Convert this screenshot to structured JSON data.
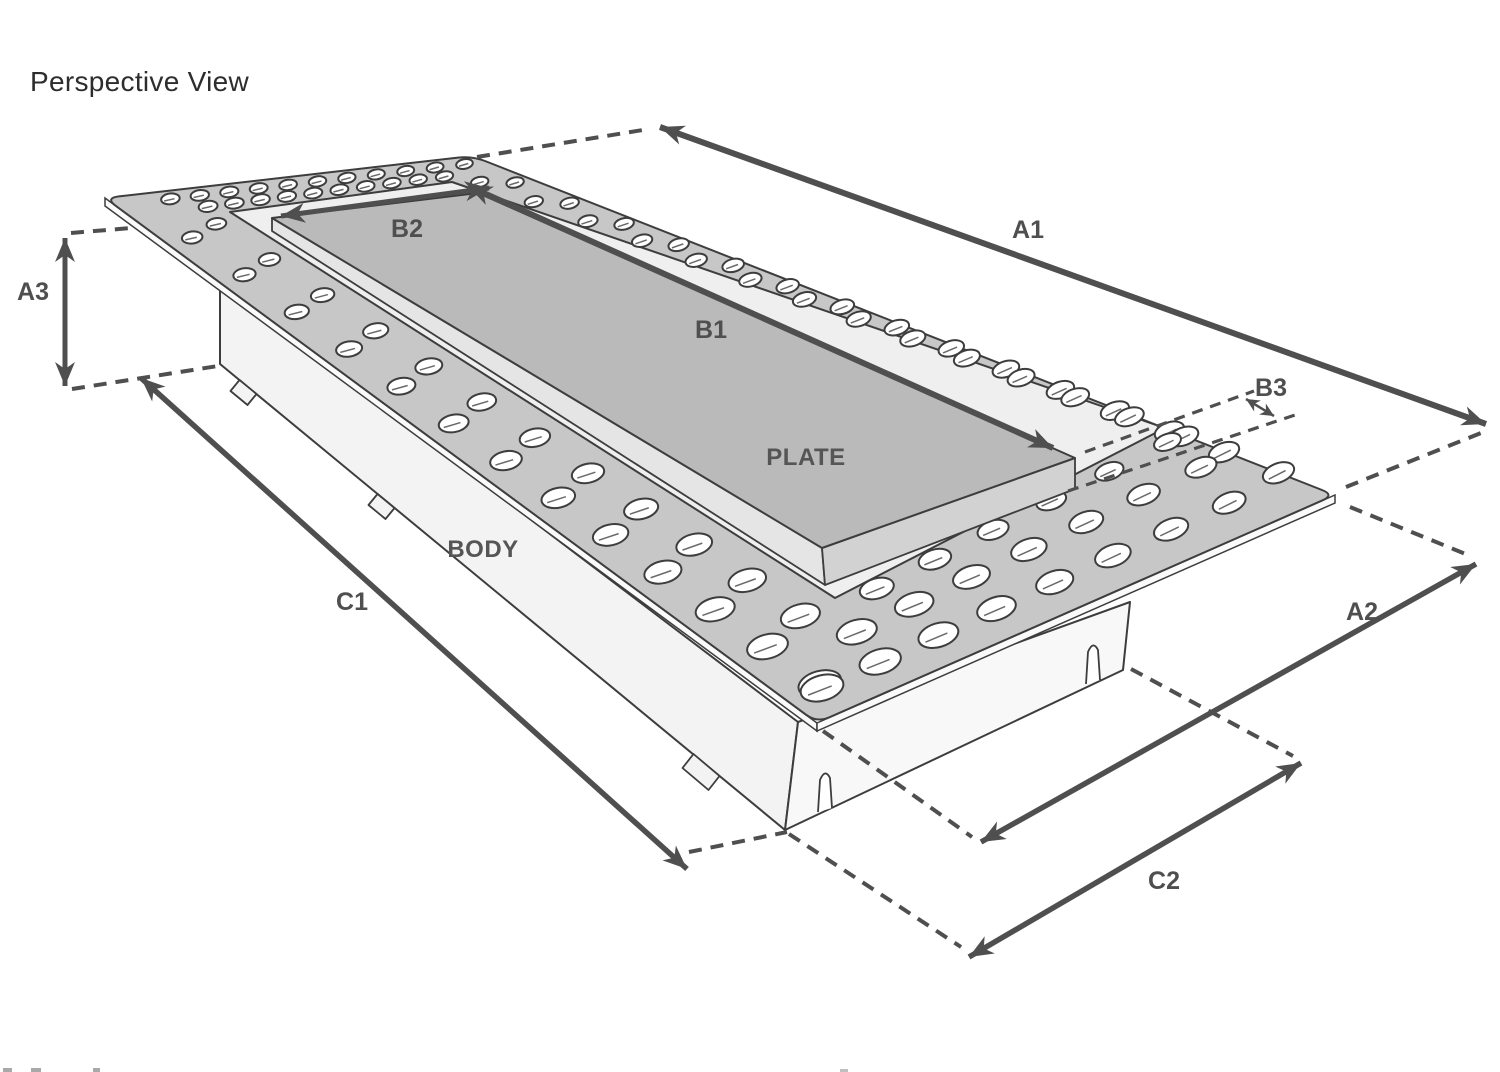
{
  "title": "Perspective View",
  "part_labels": {
    "plate": "PLATE",
    "body": "BODY"
  },
  "dimensions": {
    "A1": "A1",
    "A2": "A2",
    "A3": "A3",
    "B1": "B1",
    "B2": "B2",
    "B3": "B3",
    "C1": "C1",
    "C2": "C2"
  },
  "colors": {
    "background": "#ffffff",
    "line": "#3d3d3d",
    "dim": "#4f4f4f",
    "label": "#555555",
    "title": "#2d2d2d",
    "flange": "#c6c7c6",
    "flange_edge": "#fafafa",
    "recess": "#eeefee",
    "plate": "#b9bab9",
    "plate_bevel_left": "#e5e5e5",
    "plate_bevel_right": "#d2d2d2",
    "body_left": "#f3f3f3",
    "body_right": "#f8f8f8",
    "hole_fill": "#ffffff",
    "hole_detail": "#6a6a6a"
  }
}
